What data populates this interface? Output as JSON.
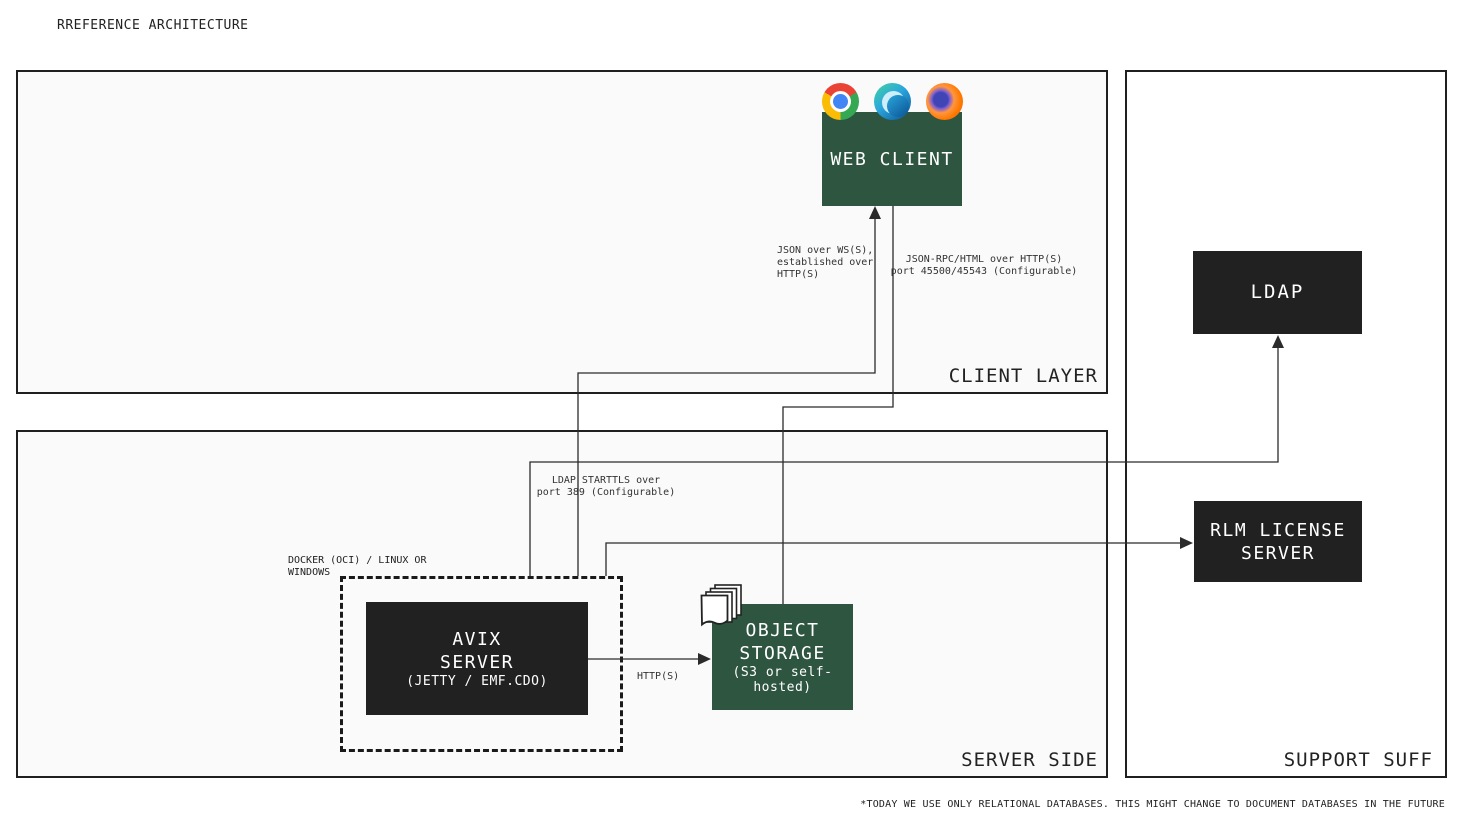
{
  "page": {
    "title": "RREFERENCE ARCHITECTURE",
    "footnote": "*TODAY WE USE ONLY RELATIONAL DATABASES. THIS MIGHT CHANGE TO DOCUMENT DATABASES IN THE FUTURE"
  },
  "layers": {
    "client": {
      "label": "CLIENT LAYER"
    },
    "server": {
      "label": "SERVER SIDE"
    },
    "support": {
      "label": "SUPPORT SUFF"
    }
  },
  "nodes": {
    "web_client": {
      "title": "WEB CLIENT",
      "icons": [
        "chrome-icon",
        "edge-icon",
        "firefox-icon"
      ]
    },
    "docker_host": {
      "label_line1": "DOCKER (OCI) / LINUX OR",
      "label_line2": "WINDOWS"
    },
    "avix_server": {
      "line1": "AVIX",
      "line2": "SERVER",
      "subtitle": "(JETTY / EMF.CDO)"
    },
    "object_storage": {
      "line1": "OBJECT",
      "line2": "STORAGE",
      "subtitle_line1": "(S3 or self-",
      "subtitle_line2": "hosted)",
      "icon": "documents-stack-icon"
    },
    "ldap": {
      "title": "LDAP"
    },
    "rlm": {
      "title_line1": "RLM LICENSE",
      "title_line2": "SERVER"
    }
  },
  "connections": {
    "ws": {
      "from": "AVIX SERVER (docker host)",
      "to": "WEB CLIENT",
      "label_line1": "JSON over WS(S),",
      "label_line2": "established over",
      "label_line3": "HTTP(S)"
    },
    "rpc": {
      "from": "WEB CLIENT",
      "to": "OBJECT STORAGE",
      "label_line1": "JSON-RPC/HTML over HTTP(S)",
      "label_line2": "port 45500/45543 (Configurable)"
    },
    "ldap": {
      "from": "AVIX SERVER (docker host)",
      "to": "LDAP",
      "label_line1": "LDAP STARTTLS over",
      "label_line2": "port 389 (Configurable)"
    },
    "rlm": {
      "from": "AVIX SERVER (docker host)",
      "to": "RLM LICENSE SERVER",
      "label": ""
    },
    "http": {
      "from": "AVIX SERVER",
      "to": "OBJECT STORAGE",
      "label": "HTTP(S)"
    }
  },
  "colors": {
    "green": "#2e5540",
    "dark": "#212121",
    "line": "#2b2b2b",
    "panel_fill": "#fafafa",
    "support_fill": "#ffffff",
    "border": "#1f1f1f",
    "label_text": "#333333",
    "page_bg": "#ffffff"
  }
}
